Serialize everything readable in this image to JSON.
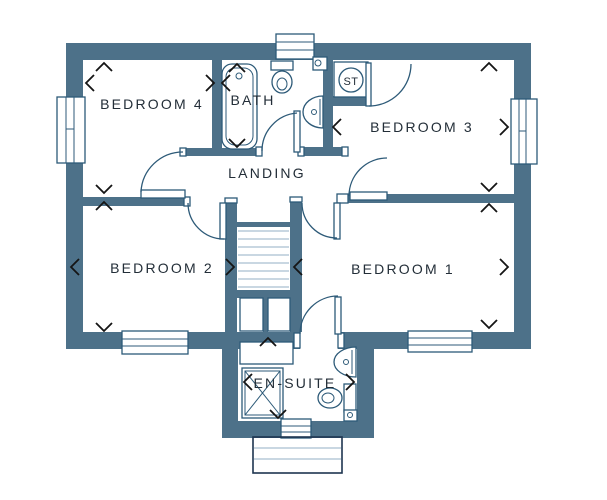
{
  "floorplan": {
    "rooms": {
      "bedroom4": "BEDROOM 4",
      "bath": "BATH",
      "storage": "ST",
      "bedroom3": "BEDROOM 3",
      "landing": "LANDING",
      "bedroom2": "BEDROOM 2",
      "bedroom1": "BEDROOM 1",
      "ensuite": "EN-SUITE"
    },
    "colors": {
      "wall": "#4d7189",
      "line": "#2d5a78",
      "tread": "#a9bfd0",
      "text": "#232e38",
      "arrow": "#151515",
      "bg": "#ffffff",
      "porch": "#1e3550"
    },
    "fixtures": [
      "bathtub",
      "toilet",
      "wash-basin",
      "shower",
      "storage-cupboard",
      "airing-cupboard",
      "stairs",
      "window",
      "door-swing",
      "porch-canopy"
    ]
  }
}
